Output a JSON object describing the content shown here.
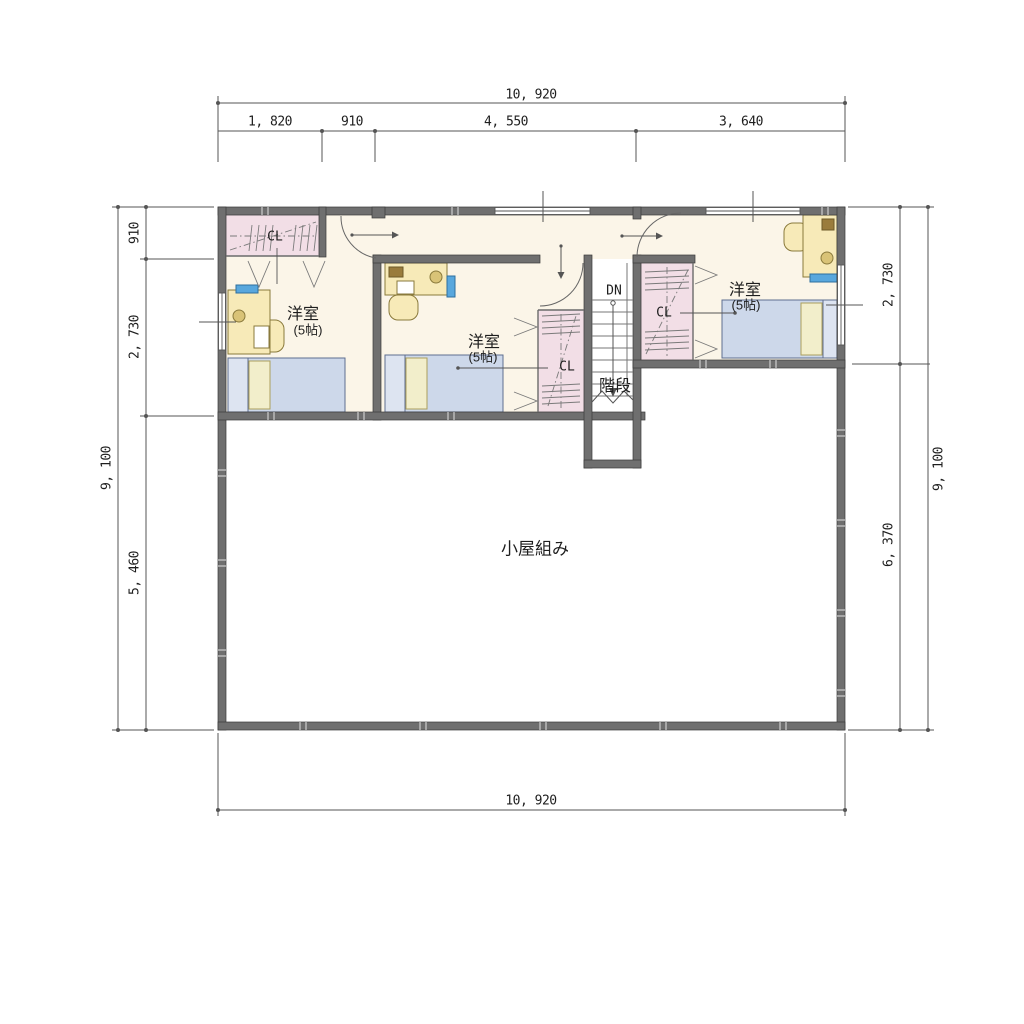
{
  "title": "2F floor plan",
  "dimensions": {
    "top": {
      "total": "10, 920",
      "segments": [
        "1, 820",
        "910",
        "4, 550",
        "3, 640"
      ]
    },
    "bottom": {
      "total": "10, 920"
    },
    "left": {
      "total": "9, 100",
      "segments": [
        "910",
        "2, 730",
        "5, 460"
      ]
    },
    "right": {
      "total": "9, 100",
      "segments": [
        "2, 730",
        "6, 370"
      ]
    }
  },
  "rooms": {
    "room1": {
      "name": "洋室",
      "size": "(5帖)"
    },
    "room2": {
      "name": "洋室",
      "size": "(5帖)"
    },
    "room3": {
      "name": "洋室",
      "size": "(5帖)"
    },
    "closet1": {
      "label": "CL"
    },
    "closet2": {
      "label": "CL"
    },
    "closet3": {
      "label": "CL"
    },
    "stairs": {
      "label": "階段",
      "direction": "DN"
    },
    "attic": {
      "label": "小屋組み"
    }
  },
  "colors": {
    "wall_gray": "#6f6f6f",
    "room_cream": "#fbf5e8",
    "closet_pink": "#f2dee6",
    "bed_blue": "#cdd8ea",
    "pillow_yellow": "#f2eecb",
    "desk_yellow": "#f7eab8",
    "item_blue": "#58a7dd",
    "line_gray": "#555555"
  }
}
